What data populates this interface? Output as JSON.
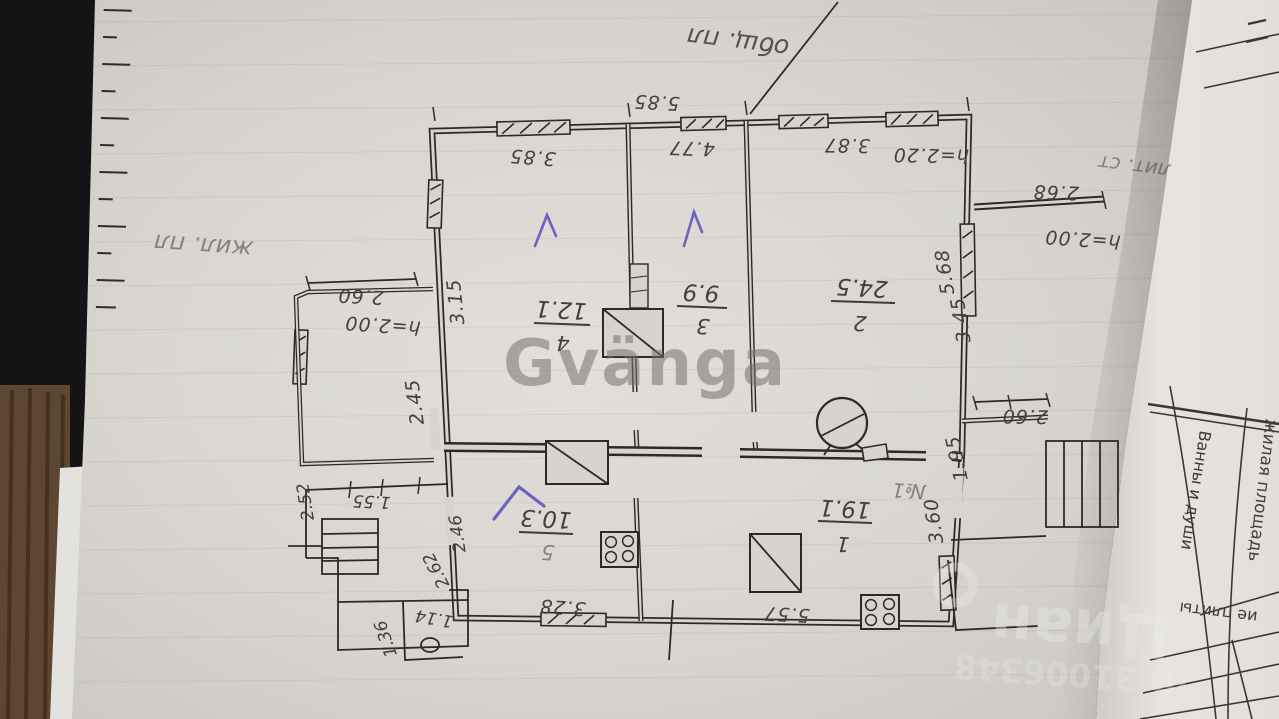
{
  "watermarks": {
    "center": "Gvänga",
    "corner_brand": "Циан",
    "corner_id": "ID 31006348"
  },
  "notes": {
    "total_area": "общ. пл",
    "living_area": "жил. пл",
    "liter": "лит. ст",
    "porch_no": "№1"
  },
  "rooms": [
    {
      "number": "1",
      "area": "19.1"
    },
    {
      "number": "2",
      "area": "24.5"
    },
    {
      "number": "3",
      "area": "9.9"
    },
    {
      "number": "4",
      "area": "12.1"
    },
    {
      "number": "5",
      "area": "10.3"
    }
  ],
  "dims": {
    "top_total": "5.85",
    "room4_width": "3.85",
    "room3_width": "4.77",
    "room2_width": "3.87",
    "room2_height_note": "h=2.20",
    "room4_depth": "3.15",
    "right_wall_a": "5.68",
    "right_wall_b": "3.45",
    "terrace_length": "2.68",
    "terrace_height": "h=2.00",
    "veranda_width": "2.60",
    "veranda_height": "h=2.00",
    "veranda_depth": "2.45",
    "porch_a": "2.52",
    "porch_b": "1.55",
    "porch_c": "2.46",
    "porch_d": "2.62",
    "porch_e": "1.36",
    "porch_f": "1.14",
    "kitchen_window": "3.28",
    "room1_bottom": "5.57",
    "right_porch_a": "2.60",
    "right_porch_b": "1.95",
    "right_porch_c": "3.60"
  },
  "side_page": {
    "columns": [
      "жилая площадь",
      "Ванны и души",
      "ие плиты"
    ]
  }
}
